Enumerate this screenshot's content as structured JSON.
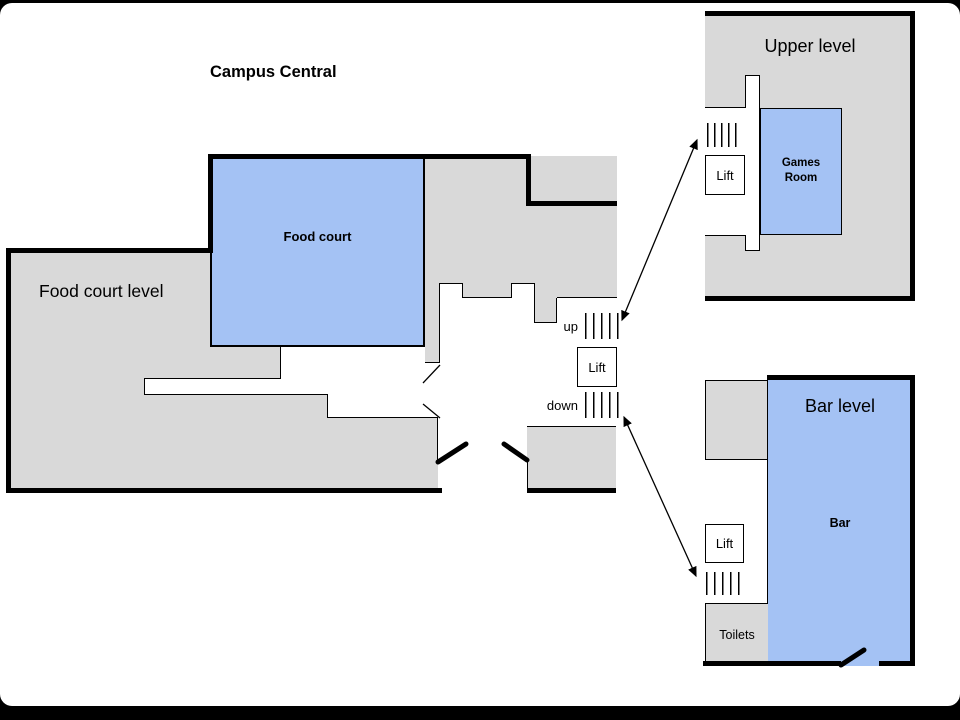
{
  "title": "Campus Central",
  "colors": {
    "room_gray": "#d9d9d9",
    "room_blue": "#a4c2f4",
    "wall": "#000000"
  },
  "main_level": {
    "label": "Food court level",
    "rooms": {
      "food_court": "Food court"
    },
    "stairs": {
      "up_label": "up",
      "down_label": "down"
    },
    "lift_label": "Lift"
  },
  "upper_level": {
    "title": "Upper level",
    "lift_label": "Lift",
    "rooms": {
      "games_room": "Games Room"
    }
  },
  "bar_level": {
    "title": "Bar level",
    "lift_label": "Lift",
    "rooms": {
      "bar": "Bar",
      "toilets": "Toilets"
    }
  }
}
